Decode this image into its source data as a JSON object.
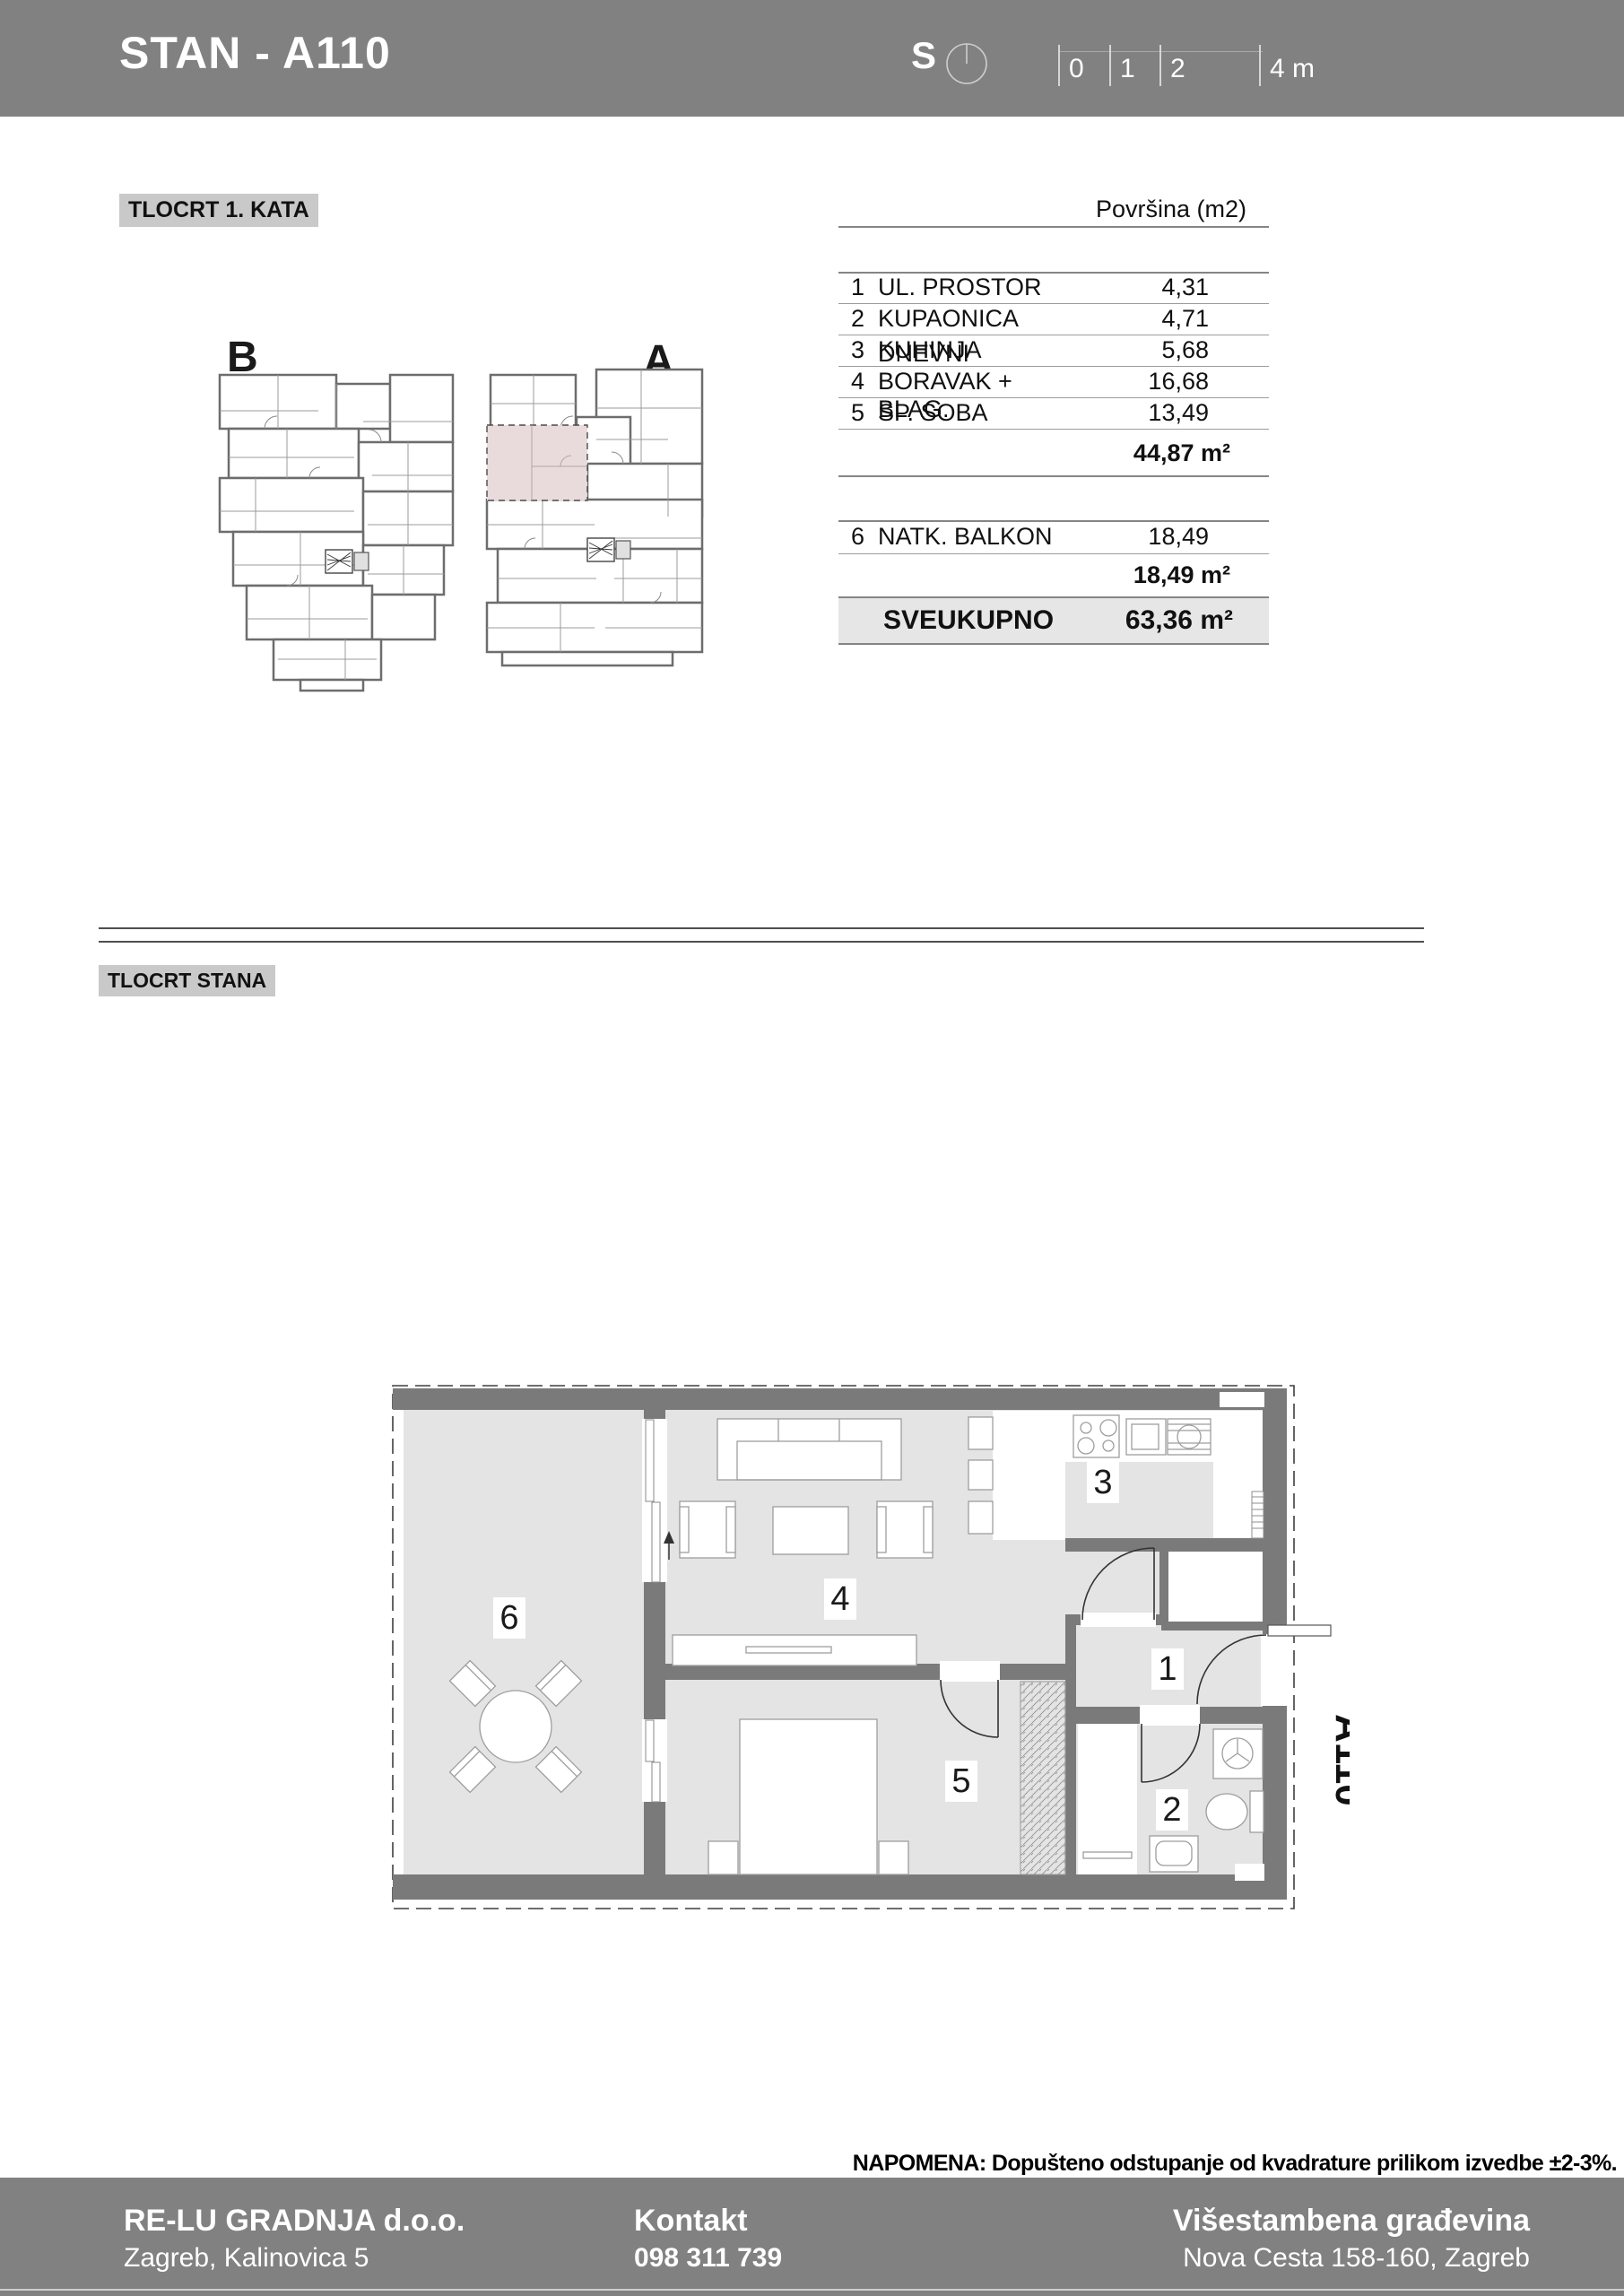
{
  "header": {
    "title": "STAN - A110",
    "north_label": "S",
    "scale_ticks": [
      "0",
      "1",
      "2",
      "4 m"
    ]
  },
  "plan_overview": {
    "section_label": "TLOCRT 1. KATA",
    "building_b": "B",
    "building_a": "A"
  },
  "area_table": {
    "column_header": "Površina (m2)",
    "rows": [
      {
        "num": "1",
        "name": "UL. PROSTOR",
        "value": "4,31"
      },
      {
        "num": "2",
        "name": "KUPAONICA",
        "value": "4,71"
      },
      {
        "num": "3",
        "name": "KUHINJA",
        "value": "5,68"
      },
      {
        "num": "4",
        "name": "DNEVNI BORAVAK + BLAG.",
        "value": "16,68"
      },
      {
        "num": "5",
        "name": "SP. SOBA",
        "value": "13,49"
      }
    ],
    "subtotal": "44,87 m²",
    "balcony_row": {
      "num": "6",
      "name": "NATK. BALKON",
      "value": "18,49"
    },
    "balcony_subtotal": "18,49 m²",
    "total_label": "SVEUKUPNO",
    "total_value": "63,36 m²"
  },
  "apartment_plan": {
    "section_label": "TLOCRT STANA",
    "unit_label": "A110",
    "room_numbers": [
      "1",
      "2",
      "3",
      "4",
      "5",
      "6"
    ]
  },
  "note": "NAPOMENA: Dopušteno odstupanje od kvadrature prilikom izvedbe ±2-3%.",
  "footer": {
    "company_name": "RE-LU GRADNJA d.o.o.",
    "company_address": "Zagreb, Kalinovica 5",
    "contact_label": "Kontakt",
    "contact_phone": "098 311 739",
    "building_name": "Višestambena građevina",
    "building_address": "Nova Cesta 158-160, Zagreb"
  },
  "colors": {
    "band_gray": "#818181",
    "wall_gray": "#7a7a7a",
    "floor_gray": "#e4e4e4",
    "label_bg": "#c9c9c9",
    "highlight_pink": "#e9dbdb",
    "total_row_bg": "#e6e6e6"
  }
}
